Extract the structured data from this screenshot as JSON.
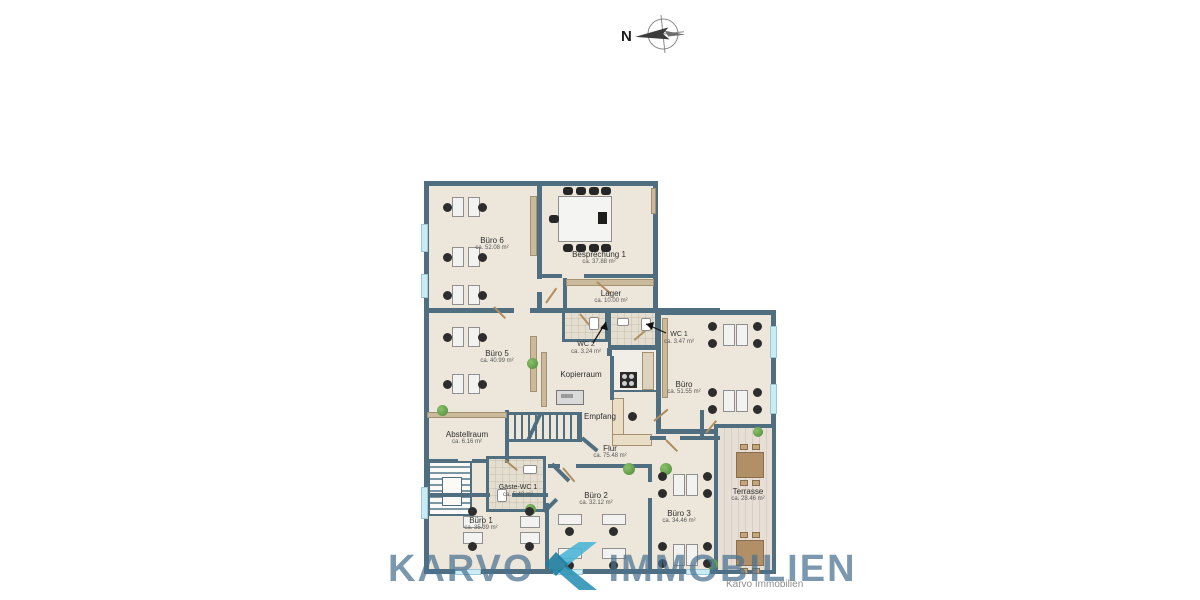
{
  "compass": {
    "label": "N"
  },
  "watermark": {
    "word_left": "KARVO",
    "word_right": "IMMOBILIEN"
  },
  "caption": "Karvo Immobilien",
  "colors": {
    "wall": "#4f6f81",
    "floor": "#ede6da",
    "window": "#c9ecf4",
    "watermark_text": "#49708F",
    "logo_teal": "#3fb0d0"
  },
  "rooms": [
    {
      "id": "buero6",
      "name": "Büro 6",
      "area": "ca. 52.08 m²"
    },
    {
      "id": "besprechung1",
      "name": "Besprechung 1",
      "area": "ca. 37.88 m²"
    },
    {
      "id": "lager",
      "name": "Lager",
      "area": "ca. 10.00 m²"
    },
    {
      "id": "wc2",
      "name": "WC 2",
      "area": "ca. 3.24 m²"
    },
    {
      "id": "wc1",
      "name": "WC 1",
      "area": "ca. 3.47 m²"
    },
    {
      "id": "buero5",
      "name": "Büro 5",
      "area": "ca. 40.99 m²"
    },
    {
      "id": "kopierraum",
      "name": "Kopierraum",
      "area": ""
    },
    {
      "id": "buero",
      "name": "Büro",
      "area": "ca. 51.55 m²"
    },
    {
      "id": "empfang",
      "name": "Empfang",
      "area": ""
    },
    {
      "id": "abstellraum",
      "name": "Abstellraum",
      "area": "ca. 6.16 m²"
    },
    {
      "id": "flur",
      "name": "Flur",
      "area": "ca. 75.48 m²"
    },
    {
      "id": "gaestewc1",
      "name": "Gäste-WC 1",
      "area": "ca. 5.43 m²"
    },
    {
      "id": "buero2",
      "name": "Büro 2",
      "area": "ca. 32.12 m²"
    },
    {
      "id": "buero3",
      "name": "Büro 3",
      "area": "ca. 34.46 m²"
    },
    {
      "id": "buero1",
      "name": "Büro 1",
      "area": "ca. 35.39 m²"
    },
    {
      "id": "terrasse",
      "name": "Terrasse",
      "area": "ca. 28.46 m²"
    }
  ]
}
